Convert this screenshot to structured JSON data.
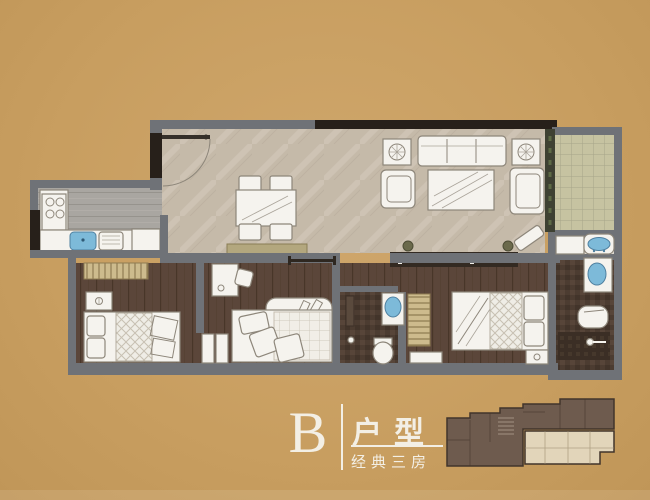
{
  "background_color": "#c89e60",
  "title_block": {
    "unit_letter": "B",
    "type_label": "户型",
    "subtitle": "经典三房"
  },
  "palette": {
    "wall": "#6f7277",
    "structural_wall": "#27201a",
    "wood_floor": "#5b463a",
    "marble_floor": "#c5baa9",
    "kitchen_floor": "#a9a6a1",
    "balcony_tile": "#c6c3a1",
    "bath_tile": "#4c3c31",
    "water": "#7dbad9",
    "furniture": "#f5f3ee",
    "wardrobe": "#cdbb8d",
    "glass_strip": "#3e4132",
    "keyplan_highlight": "#6e5b4e",
    "keyplan_rest": "#e2d5ba",
    "text": "#f3efe5"
  }
}
